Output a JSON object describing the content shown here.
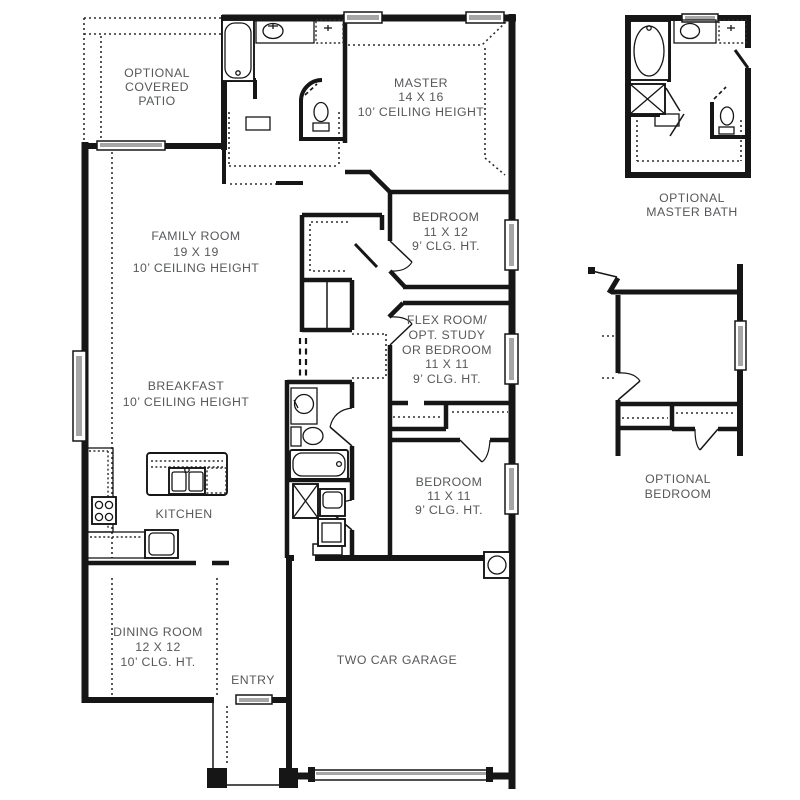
{
  "plan_title": "single-story floor plan",
  "colors": {
    "wall": "#161616",
    "label_text": "#57585a",
    "window_glass": "#a6a6a6",
    "background": "#ffffff"
  },
  "rooms": {
    "patio": {
      "lines": [
        "OPTIONAL",
        "COVERED",
        "PATIO"
      ]
    },
    "master": {
      "lines": [
        "MASTER",
        "14 X 16",
        "10’ CEILING HEIGHT"
      ]
    },
    "family": {
      "lines": [
        "FAMILY ROOM",
        "19 X 19",
        "10’ CEILING HEIGHT"
      ]
    },
    "bedroom2": {
      "lines": [
        "BEDROOM",
        "11 X 12",
        "9’ CLG. HT."
      ]
    },
    "flex": {
      "lines": [
        "FLEX ROOM/",
        "OPT. STUDY",
        "OR BEDROOM",
        "11 X 11",
        "9’ CLG. HT."
      ]
    },
    "breakfast": {
      "lines": [
        "BREAKFAST",
        "10’ CEILING HEIGHT"
      ]
    },
    "bedroom3": {
      "lines": [
        "BEDROOM",
        "11 X 11",
        "9’ CLG. HT."
      ]
    },
    "kitchen": {
      "lines": [
        "KITCHEN"
      ]
    },
    "dining": {
      "lines": [
        "DINING ROOM",
        "12 X 12",
        "10’ CLG. HT."
      ]
    },
    "entry": {
      "lines": [
        "ENTRY"
      ]
    },
    "garage": {
      "lines": [
        "TWO CAR GARAGE"
      ]
    },
    "opt_master_bath": {
      "lines": [
        "OPTIONAL",
        "MASTER BATH"
      ]
    },
    "opt_bedroom": {
      "lines": [
        "OPTIONAL",
        "BEDROOM"
      ]
    }
  },
  "symbols": [
    "bathtub-icon",
    "oval-tub-icon",
    "vanity-sink-icon",
    "shower-icon",
    "toilet-icon",
    "kitchen-island-icon",
    "double-sink-icon",
    "dishwasher-icon",
    "range-icon",
    "refrigerator-icon",
    "washer-icon",
    "dryer-icon",
    "water-heater-icon",
    "window-icon",
    "door-swing-icon",
    "sliding-door-icon",
    "garage-door-icon",
    "closet-shelf-icon",
    "ceiling-break-icon"
  ]
}
